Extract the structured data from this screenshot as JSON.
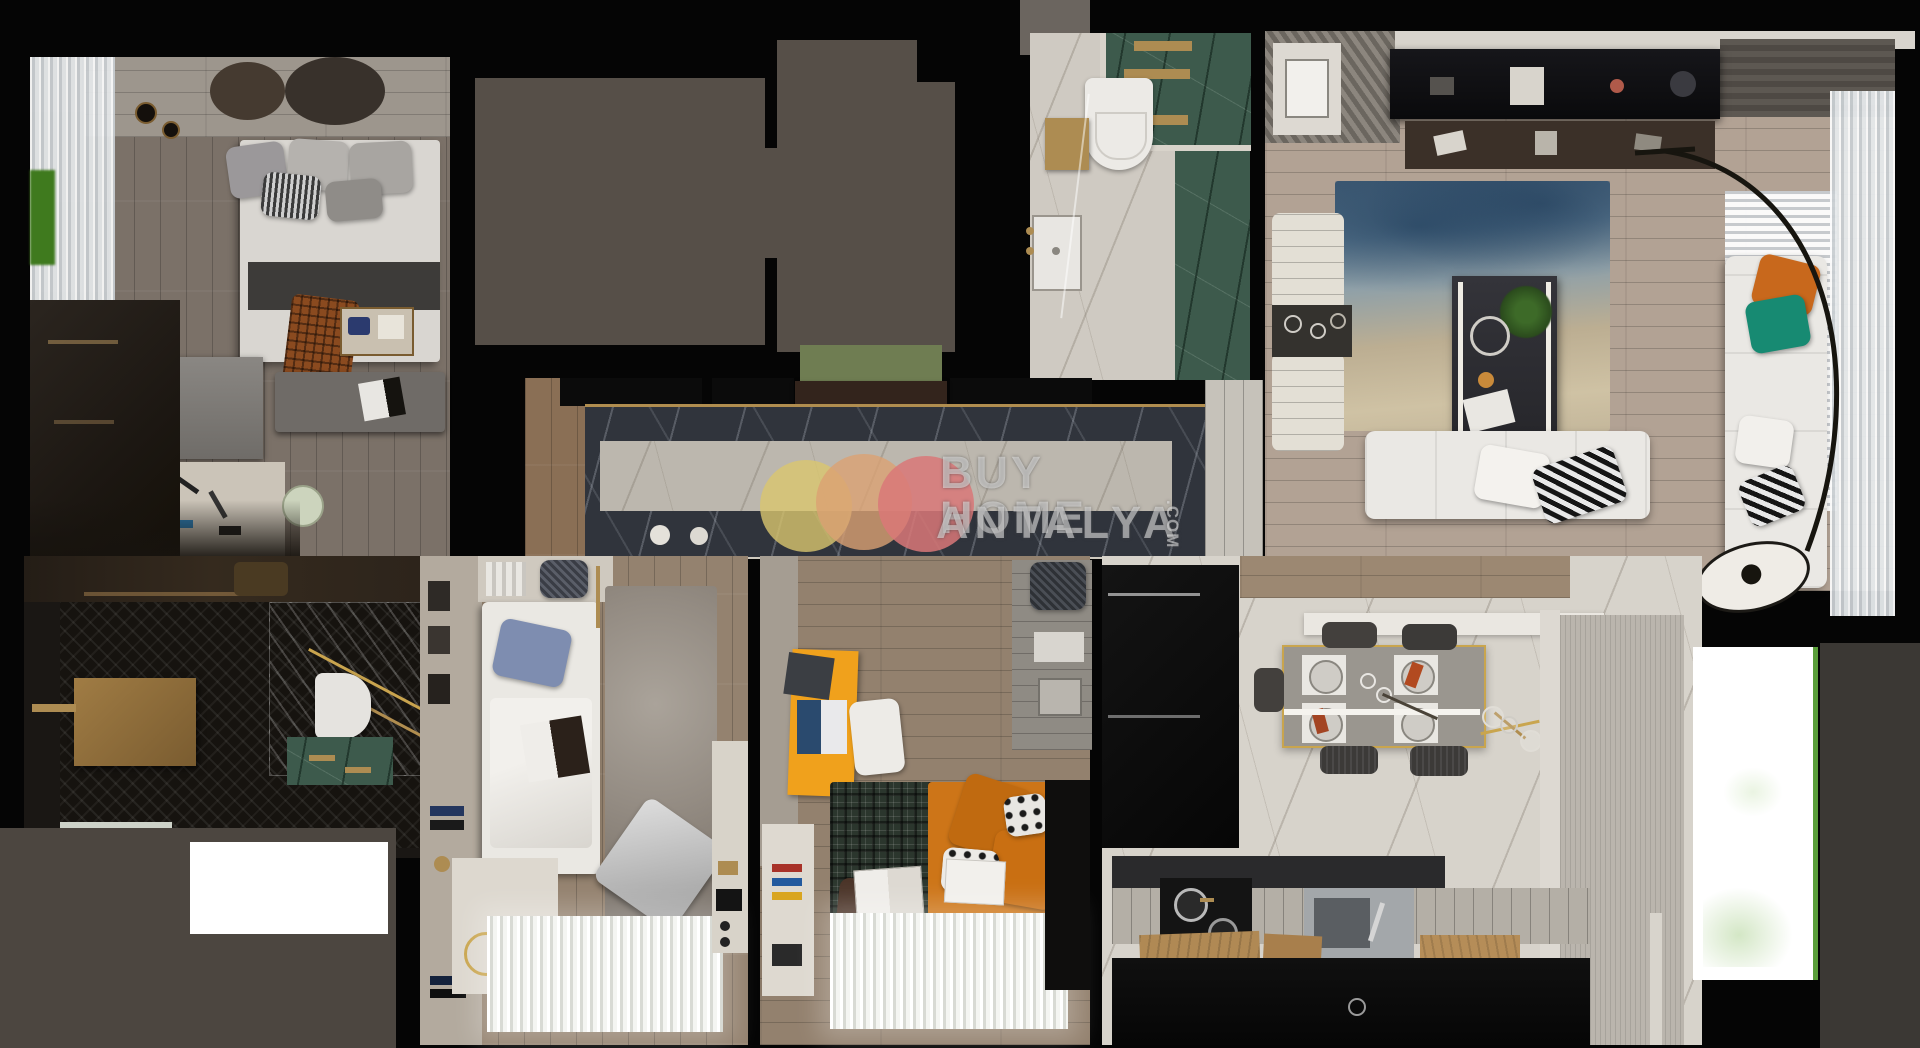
{
  "watermark": {
    "line1": "BUY HOME",
    "line2": "ANTALYA",
    "suffix": ".COM",
    "text_color": "rgba(235,235,235,0.55)",
    "circles": {
      "c1": "#d9c66e",
      "c2": "#dba173",
      "c3": "#d97878"
    }
  },
  "palette": {
    "background": "#050505",
    "roof_gray": "#564f48",
    "roof_gray_light": "#6b655f",
    "outside_gray_right": "#3b3834",
    "outside_gray_left": "#4c4640",
    "green_glass": "#6f7d52",
    "green_marble": "#3d5a4c",
    "plant_green": "#3f7a1e",
    "balcony_green_edge": "#5a9e3a",
    "gold": "#ad8c52",
    "accent_orange_pillow": "#c8681c",
    "accent_teal_pillow": "#178a72",
    "accent_orange_desk": "#f0a11c",
    "accent_orange_bed": "#cd7518",
    "sofa_white": "#eae8e4",
    "rug_blue": "#5b7890",
    "rug_beige": "#c9bb9e"
  }
}
